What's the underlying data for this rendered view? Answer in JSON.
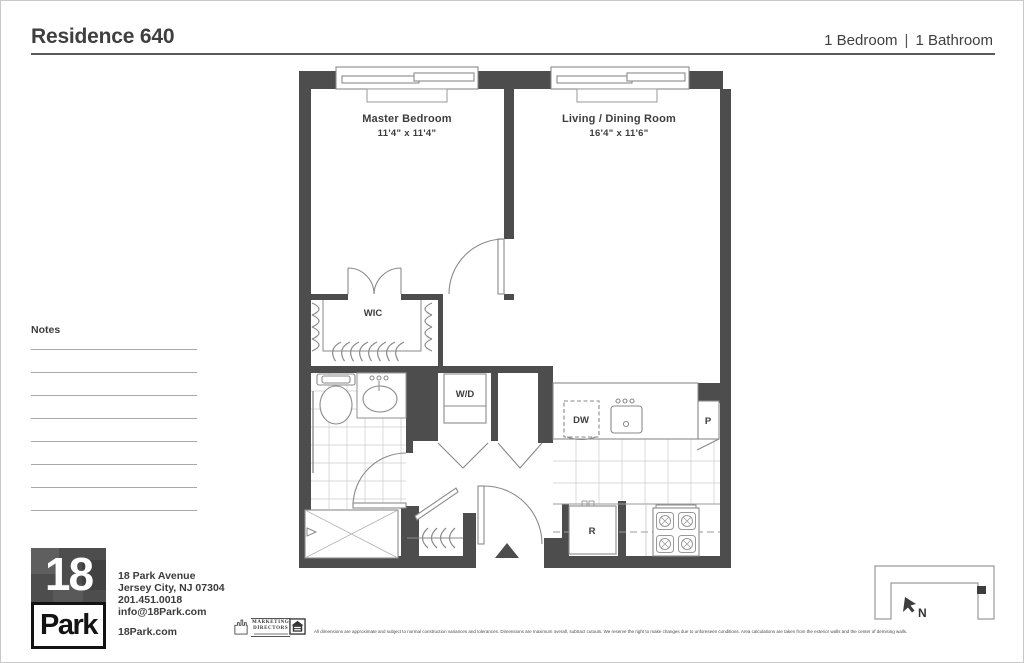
{
  "header": {
    "title": "Residence 640",
    "bedrooms": "1 Bedroom",
    "separator": "|",
    "bathrooms": "1 Bathroom"
  },
  "notes": {
    "label": "Notes"
  },
  "floorplan": {
    "master_bedroom": {
      "name": "Master Bedroom",
      "dims": "11'4\" x 11'4\""
    },
    "living_dining": {
      "name": "Living / Dining Room",
      "dims": "16'4\" x 11'6\""
    },
    "wic_label": "WIC",
    "washer_dryer_label": "W/D",
    "dishwasher_label": "DW",
    "pantry_label": "P",
    "refrigerator_label": "R",
    "north_label": "N",
    "icons": [
      "entry-arrow-icon",
      "north-arrow-icon"
    ]
  },
  "footer": {
    "logo_top": "18",
    "logo_bottom": "Park",
    "address_lines": [
      "18 Park Avenue",
      "Jersey City, NJ 07304",
      "201.451.0018",
      "info@18Park.com"
    ],
    "website": "18Park.com",
    "marketing_line1": "MARKETING",
    "marketing_line2": "DIRECTORS",
    "disclaimer": "All dimensions are approximate and subject to normal construction variances and tolerances. Dimensions are maximum overall, subtract cutouts. We reserve the right to make changes due to unforeseen conditions. Area calculations are taken from the exterior walls and the center of demising walls."
  },
  "colors": {
    "wall": "#4d4d4d",
    "text": "#3d3d3d",
    "tile_line": "#cccccc"
  }
}
